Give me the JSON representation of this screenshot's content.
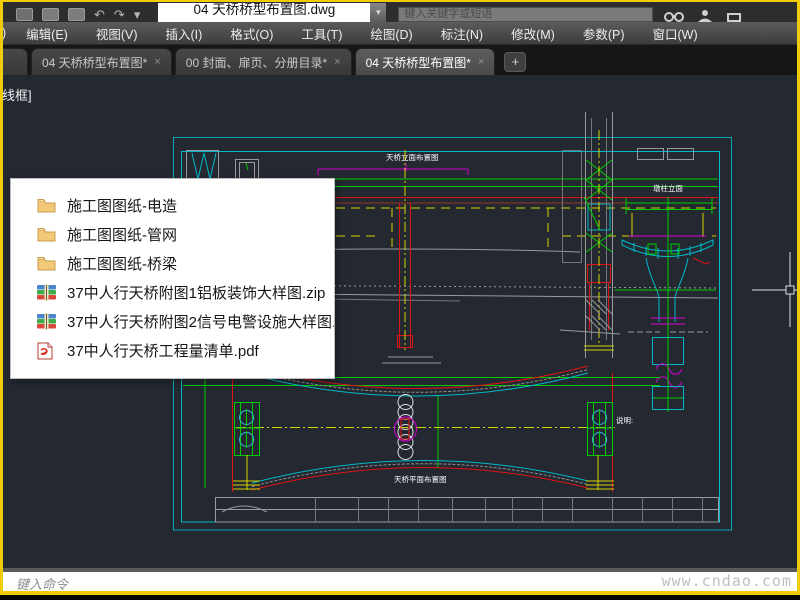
{
  "titlebar": {
    "filename": "04 天桥桥型布置图.dwg",
    "search_placeholder": "键入关键字或短语"
  },
  "menubar": {
    "items": [
      ")",
      "编辑(E)",
      "视图(V)",
      "插入(I)",
      "格式(O)",
      "工具(T)",
      "绘图(D)",
      "标注(N)",
      "修改(M)",
      "参数(P)",
      "窗口(W)"
    ]
  },
  "tabbar": {
    "tabs": [
      {
        "label": "04 天桥桥型布置图*"
      },
      {
        "label": "00 封面、扉页、分册目录*"
      },
      {
        "label": "04 天桥桥型布置图*"
      }
    ],
    "close_glyph": "×",
    "new_tab_glyph": "+"
  },
  "canvas": {
    "viewport_control": "线框]"
  },
  "popup": {
    "items": [
      {
        "type": "folder",
        "name": "施工图图纸-电造"
      },
      {
        "type": "folder",
        "name": "施工图图纸-管网"
      },
      {
        "type": "folder",
        "name": "施工图图纸-桥梁"
      },
      {
        "type": "zip",
        "name": "37中人行天桥附图1铝板装饰大样图.zip"
      },
      {
        "type": "zip",
        "name": "37中人行天桥附图2信号电警设施大样图..."
      },
      {
        "type": "pdf",
        "name": "37中人行天桥工程量清单.pdf"
      }
    ]
  },
  "drawing": {
    "elevation_title": "天桥立面布置图",
    "plan_title": "天桥平面布置图",
    "pier_title": "墩柱立面",
    "notes_label": "说明:"
  },
  "statusbar": {
    "command_prompt": "键入命令",
    "watermark": "www.cndao.com"
  },
  "colors": {
    "window_border": "#f0cc00",
    "canvas_bg": "#232831",
    "frame_cyan": "#00a8b8",
    "cad_green": "#00cc00",
    "cad_red": "#dd1414",
    "cad_yellow": "#d6d600",
    "cad_magenta": "#d400d4"
  }
}
